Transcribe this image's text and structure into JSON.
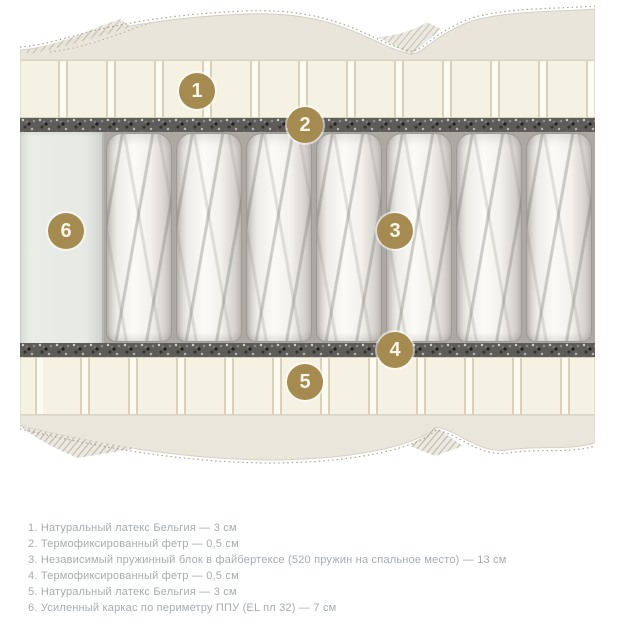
{
  "diagram": {
    "badges": [
      "1",
      "2",
      "3",
      "4",
      "5",
      "6"
    ],
    "layer_names": {
      "top_cover": "quilted cover",
      "latex_top": "natural latex layer",
      "felt_top": "thermofixed felt layer",
      "springs": "independent spring block",
      "foam_frame": "reinforced PU foam frame",
      "felt_bottom": "thermofixed felt layer",
      "latex_bottom": "natural latex layer",
      "bottom_cover": "quilted cover"
    }
  },
  "legend": {
    "items": [
      "1. Натуральный латекс Бельгия — 3 см",
      "2. Термофиксированный фетр — 0,5 см",
      "3. Независимый пружинный блок в файбертексе (520 пружин на спальное место) — 13 см",
      "4. Термофиксированный фетр — 0,5 см",
      "5. Натуральный латекс Бельгия — 3 см",
      "6. Усиленный каркас по периметру ППУ (EL пл 32) — 7 см"
    ]
  },
  "colors": {
    "badge": "#a58b4f",
    "badge_text": "#f8f5ea",
    "legend_text": "#a6abb0",
    "fabric_cover": "#e9e5da",
    "latex": "#f6f2e3",
    "felt": "#5d5c58",
    "foam_frame": "#e7e9e4",
    "background": "#ffffff"
  }
}
